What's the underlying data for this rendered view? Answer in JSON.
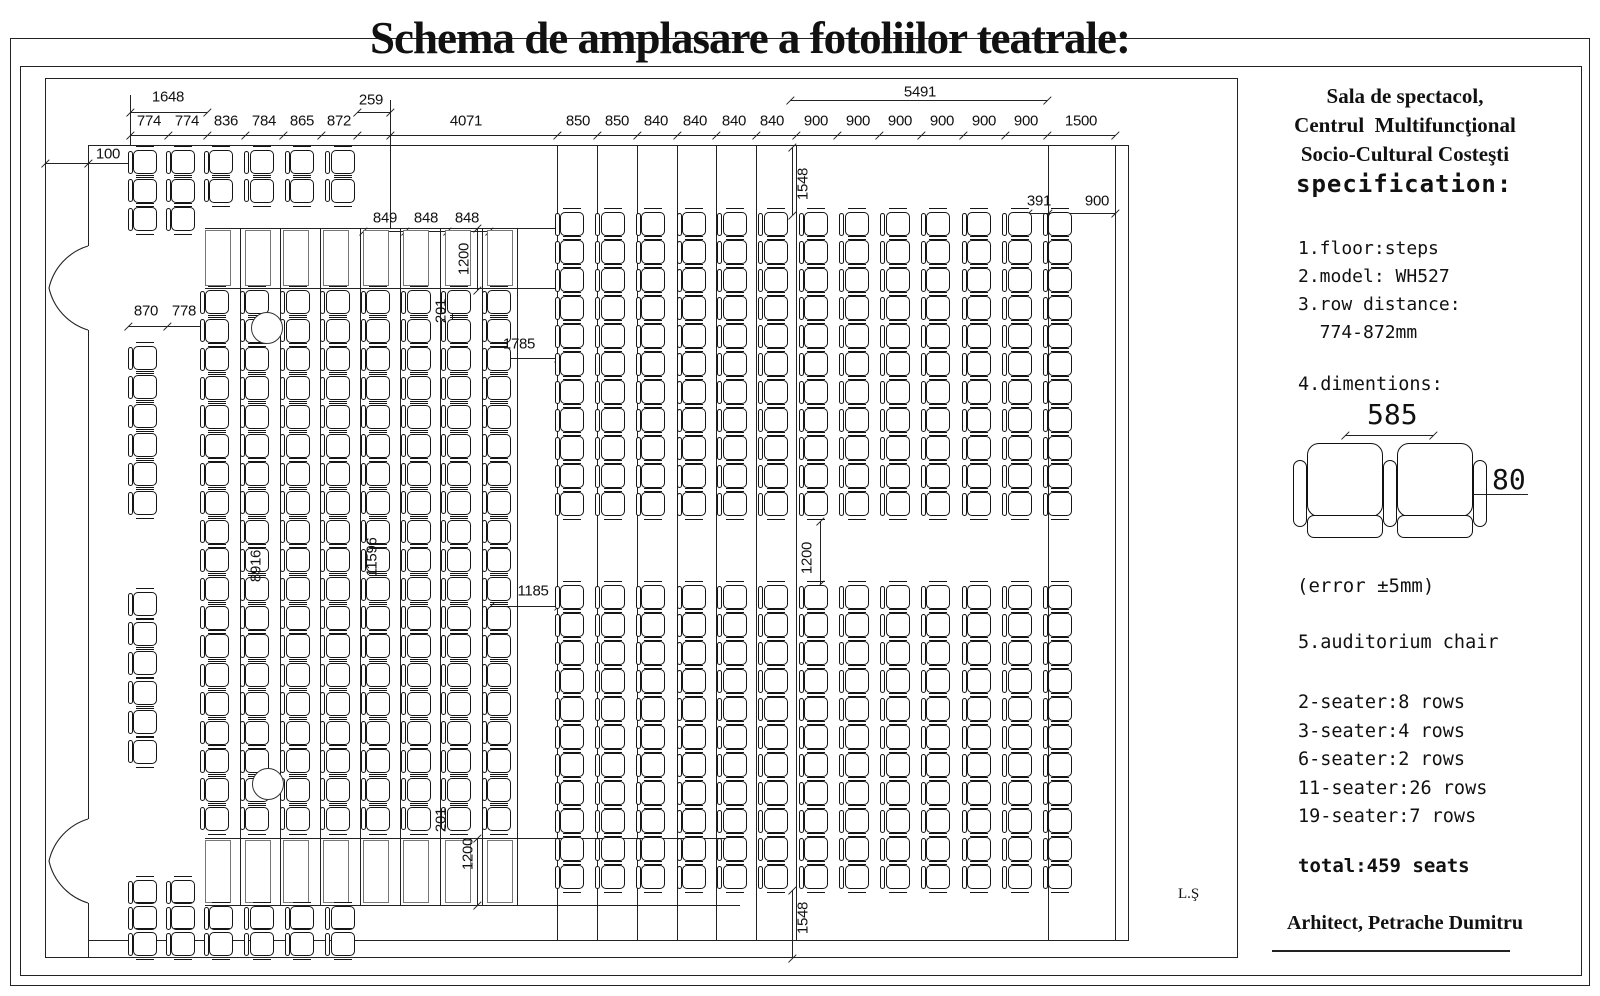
{
  "title": "Schema de amplasare a fotoliilor teatrale:",
  "stamp": "L.Ş",
  "panel": {
    "header_lines": [
      "Sala de spectacol,",
      "Centrul  Multifuncţional",
      "Socio-Cultural Costeşti"
    ],
    "spec_heading": "specification:",
    "spec_items": [
      "1.floor:steps",
      "2.model: WH527",
      "3.row distance:",
      "  774-872mm"
    ],
    "dim_heading": "4.dimentions:",
    "seat_width_label": "585",
    "seat_depth_label": "80",
    "error_note": "(error ±5mm)",
    "chair_heading": "5.auditorium chair",
    "row_counts": [
      "2-seater:8 rows",
      "3-seater:4 rows",
      "6-seater:2 rows",
      "11-seater:26 rows",
      "19-seater:7 rows"
    ],
    "total": "total:459 seats",
    "architect": "Arhitect, Petrache Dumitru"
  },
  "plan": {
    "dims": [
      {
        "v": "1648",
        "x": 168,
        "y": 97
      },
      {
        "v": "259",
        "x": 371,
        "y": 100
      },
      {
        "v": "5491",
        "x": 920,
        "y": 92
      },
      {
        "v": "774",
        "x": 149,
        "y": 121
      },
      {
        "v": "774",
        "x": 187,
        "y": 121
      },
      {
        "v": "836",
        "x": 226,
        "y": 121
      },
      {
        "v": "784",
        "x": 264,
        "y": 121
      },
      {
        "v": "865",
        "x": 302,
        "y": 121
      },
      {
        "v": "872",
        "x": 339,
        "y": 121
      },
      {
        "v": "4071",
        "x": 466,
        "y": 121
      },
      {
        "v": "850",
        "x": 578,
        "y": 121
      },
      {
        "v": "850",
        "x": 617,
        "y": 121
      },
      {
        "v": "840",
        "x": 656,
        "y": 121
      },
      {
        "v": "840",
        "x": 695,
        "y": 121
      },
      {
        "v": "840",
        "x": 734,
        "y": 121
      },
      {
        "v": "840",
        "x": 772,
        "y": 121
      },
      {
        "v": "900",
        "x": 816,
        "y": 121
      },
      {
        "v": "900",
        "x": 858,
        "y": 121
      },
      {
        "v": "900",
        "x": 900,
        "y": 121
      },
      {
        "v": "900",
        "x": 942,
        "y": 121
      },
      {
        "v": "900",
        "x": 984,
        "y": 121
      },
      {
        "v": "900",
        "x": 1026,
        "y": 121
      },
      {
        "v": "1500",
        "x": 1081,
        "y": 121
      },
      {
        "v": "100",
        "x": 108,
        "y": 154
      },
      {
        "v": "870",
        "x": 146,
        "y": 311
      },
      {
        "v": "778",
        "x": 184,
        "y": 311
      },
      {
        "v": "849",
        "x": 385,
        "y": 218
      },
      {
        "v": "848",
        "x": 426,
        "y": 218
      },
      {
        "v": "848",
        "x": 467,
        "y": 218
      },
      {
        "v": "1200",
        "x": 464,
        "y": 259,
        "r": 1
      },
      {
        "v": "201",
        "x": 441,
        "y": 311,
        "r": 1
      },
      {
        "v": "1785",
        "x": 519,
        "y": 344
      },
      {
        "v": "1548",
        "x": 803,
        "y": 184,
        "r": 1
      },
      {
        "v": "391",
        "x": 1039,
        "y": 201
      },
      {
        "v": "900",
        "x": 1097,
        "y": 201
      },
      {
        "v": "8916",
        "x": 256,
        "y": 566,
        "r": 1
      },
      {
        "v": "11596",
        "x": 372,
        "y": 557,
        "r": 1
      },
      {
        "v": "1200",
        "x": 807,
        "y": 558,
        "r": 1
      },
      {
        "v": "1185",
        "x": 533,
        "y": 591
      },
      {
        "v": "201",
        "x": 441,
        "y": 820,
        "r": 1
      },
      {
        "v": "1200",
        "x": 468,
        "y": 854,
        "r": 1
      },
      {
        "v": "1548",
        "x": 803,
        "y": 918,
        "r": 1
      }
    ],
    "hlines": [
      {
        "x": 130,
        "y": 135,
        "w": 985,
        "t": [
          130,
          168,
          207,
          245,
          283,
          321,
          357,
          390,
          557,
          597,
          637,
          677,
          716,
          756,
          796,
          837,
          879,
          921,
          963,
          1005,
          1047,
          1115
        ]
      },
      {
        "x": 130,
        "y": 112,
        "w": 77,
        "t": [
          130,
          207
        ]
      },
      {
        "x": 357,
        "y": 112,
        "w": 33,
        "t": [
          357,
          390
        ]
      },
      {
        "x": 790,
        "y": 100,
        "w": 257,
        "t": [
          790,
          1047
        ]
      },
      {
        "x": 45,
        "y": 163,
        "w": 85,
        "t": [
          45,
          88
        ]
      },
      {
        "x": 128,
        "y": 326,
        "w": 77,
        "t": [
          128,
          167,
          205
        ]
      },
      {
        "x": 363,
        "y": 231,
        "w": 126,
        "t": [
          363,
          405,
          447,
          489
        ]
      },
      {
        "x": 490,
        "y": 358,
        "w": 68,
        "t": [
          490,
          558
        ]
      },
      {
        "x": 1028,
        "y": 213,
        "w": 87,
        "t": [
          1028,
          1048,
          1115
        ]
      },
      {
        "x": 490,
        "y": 606,
        "w": 68,
        "t": [
          490,
          558
        ]
      },
      {
        "x": 205,
        "y": 228,
        "w": 352
      },
      {
        "x": 205,
        "y": 288,
        "w": 352
      },
      {
        "x": 205,
        "y": 838,
        "w": 535
      },
      {
        "x": 205,
        "y": 905,
        "w": 535
      },
      {
        "x": 88,
        "y": 145,
        "w": 1040
      },
      {
        "x": 88,
        "y": 940,
        "w": 1040
      }
    ],
    "vlines": [
      {
        "x": 88,
        "y": 145,
        "h": 101
      },
      {
        "x": 88,
        "y": 330,
        "h": 489
      },
      {
        "x": 88,
        "y": 903,
        "h": 55
      },
      {
        "x": 1115,
        "y": 145,
        "h": 796
      },
      {
        "x": 1128,
        "y": 145,
        "h": 796
      },
      {
        "x": 130,
        "y": 95,
        "h": 50
      },
      {
        "x": 390,
        "y": 100,
        "h": 129
      },
      {
        "x": 792,
        "y": 147,
        "h": 68,
        "t": [
          147,
          215
        ]
      },
      {
        "x": 477,
        "y": 228,
        "h": 62,
        "t": [
          228,
          290
        ]
      },
      {
        "x": 452,
        "y": 292,
        "h": 28
      },
      {
        "x": 1048,
        "y": 145,
        "h": 796
      },
      {
        "x": 820,
        "y": 521,
        "h": 63,
        "t": [
          521,
          584
        ]
      },
      {
        "x": 477,
        "y": 838,
        "h": 67,
        "t": [
          838,
          905
        ]
      },
      {
        "x": 792,
        "y": 890,
        "h": 68,
        "t": [
          890,
          958
        ]
      },
      {
        "x": 557,
        "y": 145,
        "h": 796
      },
      {
        "x": 597,
        "y": 145,
        "h": 796
      },
      {
        "x": 637,
        "y": 145,
        "h": 796
      },
      {
        "x": 677,
        "y": 145,
        "h": 796
      },
      {
        "x": 716,
        "y": 145,
        "h": 796
      },
      {
        "x": 756,
        "y": 145,
        "h": 796
      },
      {
        "x": 796,
        "y": 145,
        "h": 796
      },
      {
        "x": 240,
        "y": 228,
        "h": 678
      },
      {
        "x": 280,
        "y": 228,
        "h": 678
      },
      {
        "x": 320,
        "y": 228,
        "h": 678
      },
      {
        "x": 360,
        "y": 228,
        "h": 678
      },
      {
        "x": 400,
        "y": 228,
        "h": 678
      },
      {
        "x": 440,
        "y": 228,
        "h": 678
      },
      {
        "x": 482,
        "y": 228,
        "h": 678
      },
      {
        "x": 517,
        "y": 228,
        "h": 678
      }
    ],
    "seat_blocks": [
      {
        "name": "top-left-3-seater",
        "x": 133,
        "y": 150,
        "cols": 2,
        "seats": 3,
        "dx": 38,
        "dy": 28.5
      },
      {
        "name": "top-left-2-seater",
        "x": 209,
        "y": 150,
        "cols": 4,
        "seats": 2,
        "dx": 40.5,
        "dy": 28.5
      },
      {
        "name": "left-6-seater-upper",
        "x": 133,
        "y": 346,
        "cols": 1,
        "seats": 6,
        "dx": 0,
        "dy": 29
      },
      {
        "name": "left-6-seater-lower",
        "x": 133,
        "y": 592,
        "cols": 1,
        "seats": 6,
        "dx": 0,
        "dy": 29.5
      },
      {
        "name": "left-19-seater-block",
        "x": 205,
        "y": 290,
        "cols": 8,
        "seats": 19,
        "dx": 40.3,
        "dy": 28.7
      },
      {
        "name": "right-11-seater-upper",
        "x": 560,
        "y": 212,
        "cols": 13,
        "seats": 11,
        "dx": 40.7,
        "dy": 28
      },
      {
        "name": "right-11-seater-lower",
        "x": 560,
        "y": 585,
        "cols": 13,
        "seats": 11,
        "dx": 40.7,
        "dy": 28
      },
      {
        "name": "bottom-left-3-seater",
        "x": 133,
        "y": 880,
        "cols": 2,
        "seats": 3,
        "dx": 38,
        "dy": 26
      },
      {
        "name": "bottom-left-2-seater",
        "x": 209,
        "y": 906,
        "cols": 4,
        "seats": 2,
        "dx": 40.5,
        "dy": 26
      }
    ],
    "steps": [
      {
        "xs": [
          205,
          245,
          283,
          323,
          363,
          403,
          445,
          487
        ],
        "y": 230,
        "h": 56
      },
      {
        "xs": [
          205,
          245,
          283,
          323,
          363,
          403,
          445,
          487
        ],
        "y": 840,
        "h": 63
      }
    ],
    "pillars": [
      {
        "cx": 267,
        "cy": 328,
        "r": 16
      },
      {
        "cx": 268,
        "cy": 784,
        "r": 16
      }
    ],
    "doors": [
      {
        "wallX": 88,
        "y1": 246,
        "y2": 330
      },
      {
        "wallX": 88,
        "y1": 819,
        "y2": 903
      }
    ]
  }
}
